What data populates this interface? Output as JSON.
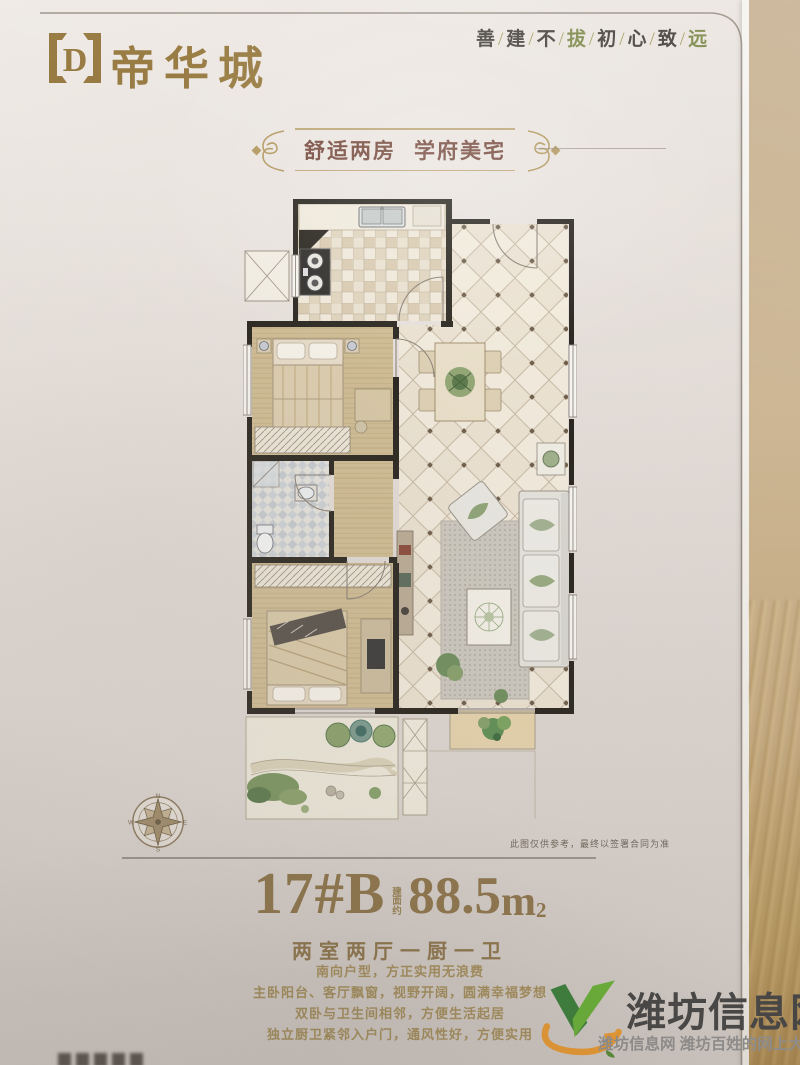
{
  "brand": {
    "logo_letter": "D",
    "name": "帝华城"
  },
  "slogan": {
    "chars": [
      "善",
      "建",
      "不",
      "拔",
      "初",
      "心",
      "致",
      "远"
    ],
    "sep": "/"
  },
  "banner": {
    "left": "舒适两房",
    "right": "学府美宅"
  },
  "floor_plan": {
    "compass": {
      "n": "N",
      "e": "E",
      "s": "S",
      "w": "W"
    },
    "disclaimer": "此图仅供参考，最终以签署合同为准"
  },
  "unit": {
    "number": "17#B",
    "area_label": "建面约",
    "area_value": "88.5",
    "area_unit": "m",
    "area_sup": "2",
    "layout": "两室两厅一厨一卫",
    "features": [
      "南向户型，方正实用无浪费",
      "主卧阳台、客厅飘窗，视野开阔，圆满幸福梦想",
      "双卧与卫生间相邻，方便生活起居",
      "独立厨卫紧邻入户门，通风性好，方便实用"
    ]
  },
  "watermark": {
    "site": "潍坊信息网",
    "tagline": "潍坊信息网 潍坊百姓的网上大集"
  },
  "colors": {
    "gold": "#96793f",
    "maroon": "#74473a",
    "wm_green": "#5fb12e",
    "wm_orange": "#f09a28"
  }
}
